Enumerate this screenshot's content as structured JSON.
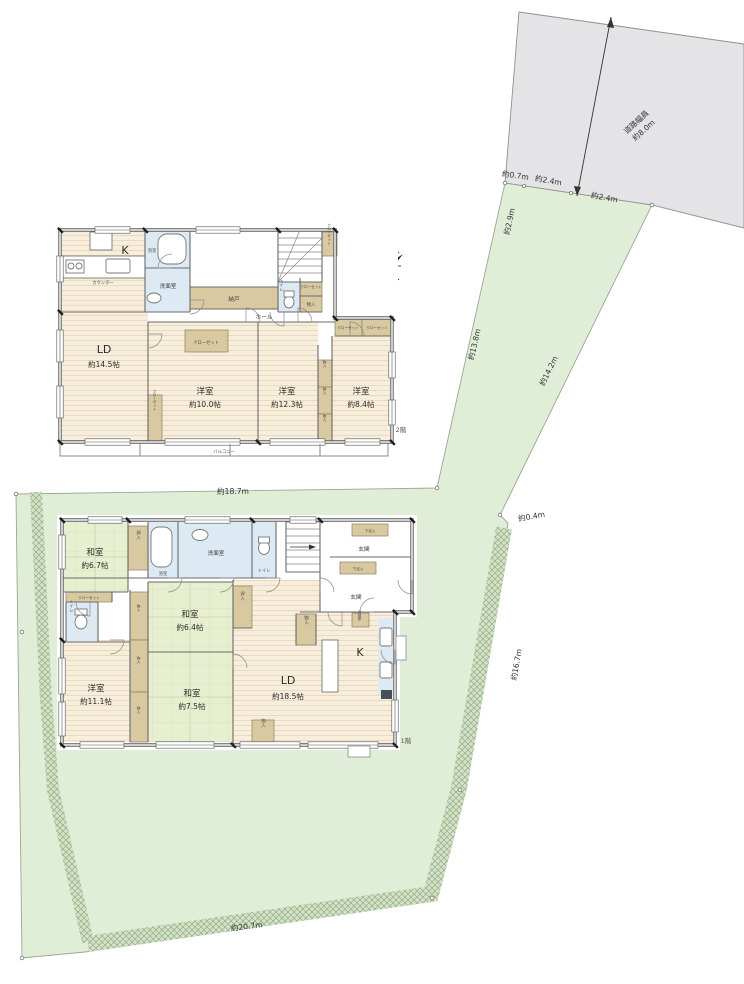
{
  "site": {
    "road_label": "道路幅員",
    "road_width": "約8.0m",
    "north_mark": "N",
    "dims": {
      "top1": "約0.7m",
      "top2": "約2.4m",
      "top3": "約2.4m",
      "slant": "約2.9m",
      "band_left": "約13.8m",
      "band_right": "約14.2m",
      "jog": "約0.4m",
      "east_side": "約16.7m",
      "house_width": "約18.7m",
      "south_side": "約20.7m"
    }
  },
  "floor2": {
    "tag": "2階",
    "kitchen": "K",
    "counter": "カウンター",
    "ld": "LD",
    "ld_size": "約14.5帖",
    "bath": "浴室",
    "washroom": "洗面室",
    "storage_room": "納戸",
    "toilet": "トイレ",
    "hall": "ホール",
    "closet": "クローゼット",
    "storage": "物入",
    "room1": "洋室",
    "room1_size": "約10.0帖",
    "room2": "洋室",
    "room2_size": "約12.3帖",
    "room3": "洋室",
    "room3_size": "約8.4帖",
    "balcony": "バルコニー"
  },
  "floor1": {
    "tag": "1階",
    "kitchen": "K",
    "ld": "LD",
    "ld_size": "約18.5帖",
    "jp_room1": "和室",
    "jp_room1_size": "約6.7帖",
    "jp_room2": "和室",
    "jp_room2_size": "約6.4帖",
    "jp_room3": "和室",
    "jp_room3_size": "約7.5帖",
    "room1": "洋室",
    "room1_size": "約11.1帖",
    "bath": "浴室",
    "washroom": "洗面室",
    "toilet": "トイレ",
    "entrance": "玄関",
    "shoe_box": "下足入",
    "oshiire": "押入",
    "storage": "物入",
    "closet": "クローゼット",
    "fridge": "冷蔵庫"
  },
  "colors": {
    "lot_green": "#e1eed7",
    "road_gray": "#e4e4e6",
    "tatami": "#e8efd0",
    "wood_floor": "#f8eedd",
    "wet_area": "#ddeaf4",
    "storage_tan": "#d9c9a1"
  }
}
